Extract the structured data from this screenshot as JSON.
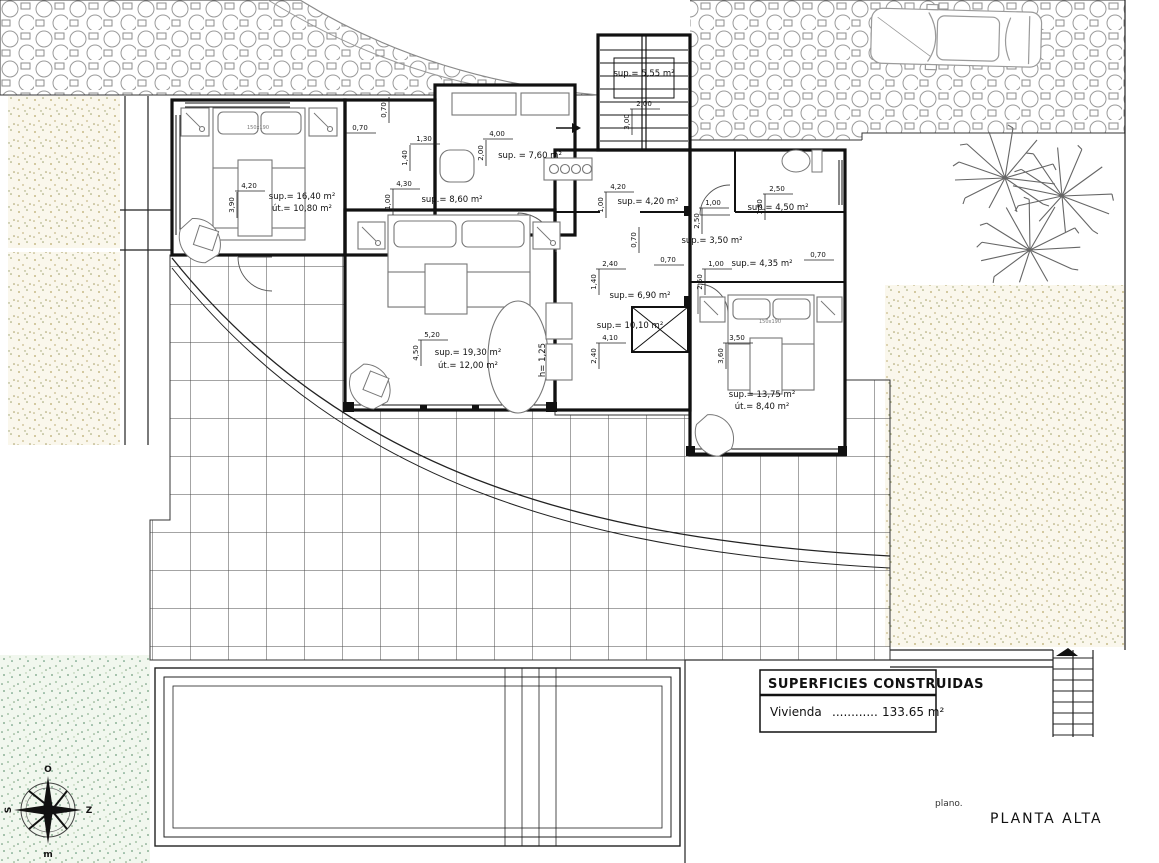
{
  "title_block": {
    "header": "SUPERFICIES CONSTRUIDAS",
    "row_label": "Vivienda",
    "row_dots": "............",
    "row_value": "133.65 m²"
  },
  "plan_caption": {
    "prefix": "plano.",
    "name": "PLANTA ALTA"
  },
  "compass": {
    "top": "O",
    "right": "Z",
    "bottom": "m",
    "left": "S"
  },
  "rooms": [
    {
      "name": "bedroom-1",
      "sup": "sup.= 16,40 m²",
      "util": "út.= 10,80 m²"
    },
    {
      "name": "master-bedroom",
      "sup": "sup.= 19,30 m²",
      "util": "út.= 12,00 m²",
      "extra": "h= 1,25"
    },
    {
      "name": "bedroom-3",
      "sup": "sup.= 13,75 m²",
      "util": "út.= 8,40 m²"
    },
    {
      "name": "kitchen",
      "sup": "sup. = 7,60 m²"
    },
    {
      "name": "hallway",
      "sup": "sup.= 8,60 m²"
    },
    {
      "name": "staircase",
      "sup": "sup.= 5,55 m²"
    },
    {
      "name": "landing",
      "sup": "sup.= 4,20 m²"
    },
    {
      "name": "dressing",
      "sup": "sup.= 3,50 m²"
    },
    {
      "name": "bathroom",
      "sup": "sup.= 4,50 m²"
    },
    {
      "name": "corridor",
      "sup": "sup.= 4,35 m²"
    },
    {
      "name": "inner-hall",
      "sup": "sup.= 6,90 m²"
    },
    {
      "name": "distributor",
      "sup": "sup.= 10,10 m²"
    }
  ],
  "dims": [
    {
      "t": "0,70",
      "x": 386,
      "y": 110,
      "v": true
    },
    {
      "t": "0,70",
      "x": 360,
      "y": 130
    },
    {
      "t": "1,30",
      "x": 424,
      "y": 141
    },
    {
      "t": "1,40",
      "x": 407,
      "y": 158,
      "v": true
    },
    {
      "t": "4,00",
      "x": 497,
      "y": 136
    },
    {
      "t": "2,00",
      "x": 483,
      "y": 153,
      "v": true
    },
    {
      "t": "2,00",
      "x": 644,
      "y": 106
    },
    {
      "t": "3,00",
      "x": 629,
      "y": 122,
      "v": true
    },
    {
      "t": "4,20",
      "x": 249,
      "y": 188
    },
    {
      "t": "3,90",
      "x": 234,
      "y": 205,
      "v": true
    },
    {
      "t": "4,30",
      "x": 404,
      "y": 186
    },
    {
      "t": "1,00",
      "x": 390,
      "y": 202,
      "v": true
    },
    {
      "t": "4,20",
      "x": 618,
      "y": 189
    },
    {
      "t": "1,00",
      "x": 603,
      "y": 205,
      "v": true
    },
    {
      "t": "2,50",
      "x": 777,
      "y": 191
    },
    {
      "t": "1,80",
      "x": 762,
      "y": 207,
      "v": true
    },
    {
      "t": "1,00",
      "x": 713,
      "y": 205
    },
    {
      "t": "2,50",
      "x": 699,
      "y": 221,
      "v": true
    },
    {
      "t": "0,70",
      "x": 636,
      "y": 240,
      "v": true
    },
    {
      "t": "0,70",
      "x": 668,
      "y": 262
    },
    {
      "t": "2,40",
      "x": 610,
      "y": 266
    },
    {
      "t": "1,40",
      "x": 596,
      "y": 282,
      "v": true
    },
    {
      "t": "4,10",
      "x": 610,
      "y": 340
    },
    {
      "t": "2,40",
      "x": 596,
      "y": 356,
      "v": true
    },
    {
      "t": "5,20",
      "x": 432,
      "y": 337
    },
    {
      "t": "4,50",
      "x": 418,
      "y": 353,
      "v": true
    },
    {
      "t": "1,00",
      "x": 716,
      "y": 266
    },
    {
      "t": "2,50",
      "x": 702,
      "y": 282,
      "v": true
    },
    {
      "t": "3,50",
      "x": 737,
      "y": 340
    },
    {
      "t": "3,60",
      "x": 723,
      "y": 356,
      "v": true
    },
    {
      "t": "0,70",
      "x": 818,
      "y": 257
    }
  ],
  "furniture_labels": [
    {
      "t": "150x190",
      "x": 258,
      "y": 129
    },
    {
      "t": "150x190",
      "x": 770,
      "y": 323
    }
  ]
}
